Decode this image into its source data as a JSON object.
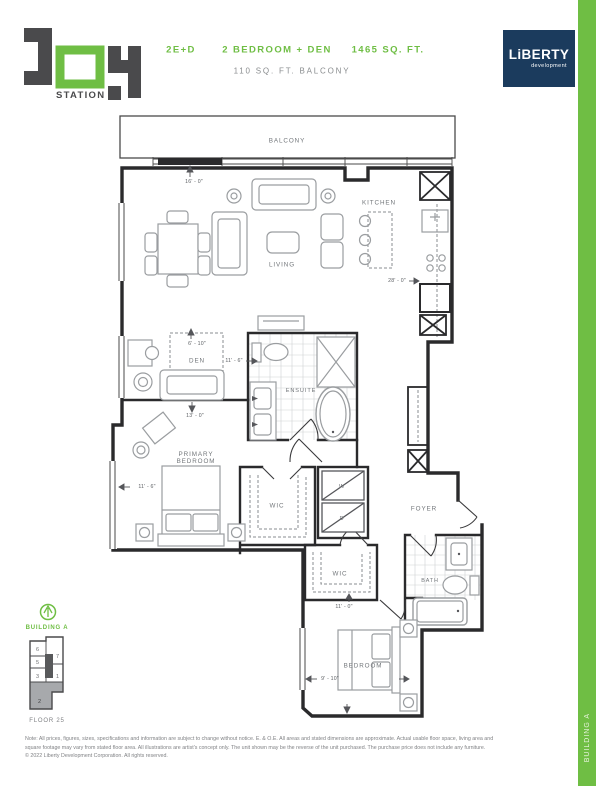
{
  "header": {
    "logo": {
      "word": "JOY",
      "sub": "STATION"
    },
    "unit_code": "2E+D",
    "unit_desc": "2 BEDROOM + DEN",
    "area": "1465 SQ. FT.",
    "balcony": "110 SQ. FT. BALCONY",
    "brand": {
      "name": "LiBERTY",
      "tagline": "development"
    }
  },
  "side_tab": {
    "label": "BUILDING A"
  },
  "plan": {
    "rooms": {
      "balcony": "BALCONY",
      "living": "LIVING",
      "kitchen": "KITCHEN",
      "den": "DEN",
      "ensuite": "ENSUITE",
      "primary_line1": "PRIMARY",
      "primary_line2": "BEDROOM",
      "wic_primary": "WIC",
      "washer": "W",
      "dryer": "D",
      "foyer": "FOYER",
      "wic_bedroom": "WIC",
      "bath": "BATH",
      "bedroom": "BEDROOM"
    },
    "dimensions": {
      "living_width": "16' - 0\"",
      "kitchen_run": "28' - 0\"",
      "den_width": "6' - 10\"",
      "den_depth": "11' - 6\"",
      "den_length": "13' - 0\"",
      "primary_width": "11' - 6\"",
      "bedroom_depth": "11' - 0\"",
      "bedroom_width": "9' - 10\""
    }
  },
  "keyplan": {
    "building": "BUILDING A",
    "floor": "FLOOR 25",
    "units": [
      "6",
      "7",
      "5",
      "3",
      "1",
      "2"
    ],
    "highlighted_unit": "2"
  },
  "footer": {
    "line1": "Note: All prices, figures, sizes, specifications and information are subject to change without notice. E. & O.E. All areas and stated dimensions are approximate. Actual usable floor space, living area and",
    "line2": "square footage may vary from stated floor area. All illustrations are artist's concept only. The unit shown may be the reverse of the unit purchased. The purchase price does not include any furniture.",
    "line3": "© 2022 Liberty Development Corporation. All rights reserved."
  },
  "colors": {
    "green": "#6FBE44",
    "navy": "#1B3B5D",
    "wall": "#2A2A2C",
    "gray_text": "#808285"
  }
}
